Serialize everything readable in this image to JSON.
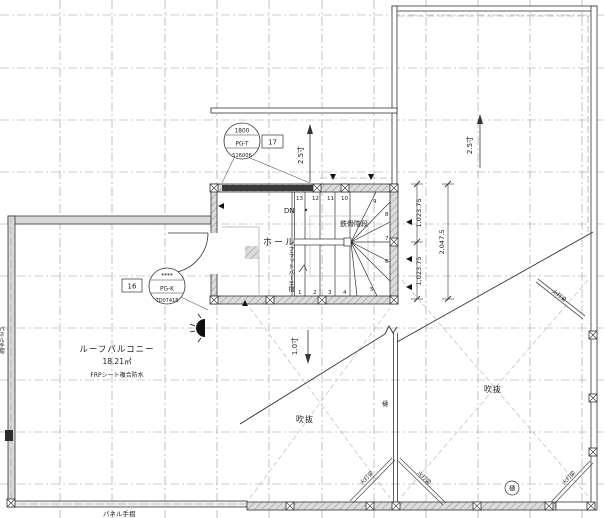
{
  "plan": {
    "rooms": {
      "hall": "ホール",
      "balcony_name": "ルーフバルコニー",
      "balcony_area": "18.21㎡",
      "balcony_spec": "FRPシート複合防水",
      "void": "吹抜"
    },
    "stair": {
      "name": "鉄骨階段",
      "dn": "DN",
      "handrail": "フラットバー手摺",
      "treads": [
        "1",
        "2",
        "3",
        "4",
        "5",
        "6",
        "7",
        "8",
        "9",
        "10",
        "11",
        "12",
        "13"
      ]
    },
    "tags": {
      "t17": {
        "size": "1800",
        "code": "PG-T",
        "id": "S16006",
        "num": "17"
      },
      "t16": {
        "size": "****",
        "code": "PG-K",
        "id": "TD07418",
        "num": "16"
      }
    },
    "slopes": {
      "stair_roof": "2.5寸",
      "main_roof": "2.5寸",
      "valley": "1.0寸"
    },
    "dims": {
      "upper": "1,023.75",
      "lower": "1,023.75",
      "total": "2,047.5"
    },
    "labels": {
      "brace": "火打梁",
      "gutter": "樋",
      "gutter_circled": "樋",
      "panel_handrail": "パネル手摺",
      "panel_handrail_left": "パネル手摺"
    },
    "colors": {
      "line": "#333333",
      "grid": "#9a9a9a",
      "wall_fill": "#d8d8d8"
    }
  }
}
